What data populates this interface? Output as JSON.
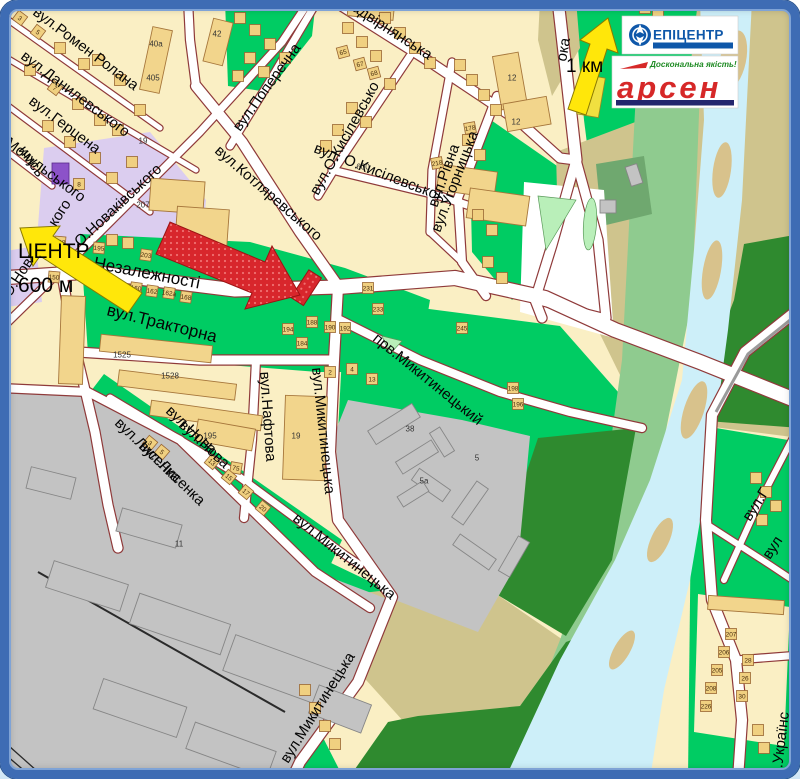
{
  "map": {
    "streets": [
      {
        "label": "вул.Ромен Ролана"
      },
      {
        "label": "вул.Данилевського"
      },
      {
        "label": "вул.Герцена"
      },
      {
        "label": "вул.Мочульського"
      },
      {
        "label": "имсь"
      },
      {
        "label": "О.Новаківського"
      },
      {
        "label": "О.Новаківського"
      },
      {
        "label": "вул.Поперечна"
      },
      {
        "label": "вул.О.Кисілевсько"
      },
      {
        "label": "вул. О.Кисілевської"
      },
      {
        "label": "вул.Рівна"
      },
      {
        "label": "Надвірнянська"
      },
      {
        "label": "вул.Угорницька"
      },
      {
        "label": "ока"
      },
      {
        "label": "вул.Котляревського"
      },
      {
        "label": "вул.Незалежності"
      },
      {
        "label": "вул.Тракторна"
      },
      {
        "label": "вул.Нафтова"
      },
      {
        "label": "прв.Микитинецький"
      },
      {
        "label": "вул.Микитинецька"
      },
      {
        "label": "вул.Микитинецька"
      },
      {
        "label": "вул.Микитинецька"
      },
      {
        "label": "вул.Нова"
      },
      {
        "label": "вул.Нова"
      },
      {
        "label": "вул.Лисенка"
      },
      {
        "label": "вул.Лисенка"
      },
      {
        "label": "вул.Г"
      },
      {
        "label": "вул"
      },
      {
        "label": "л.Українс"
      }
    ],
    "annotations": {
      "center": {
        "title": "ЦЕНТР",
        "distance": "600 м"
      },
      "north": {
        "distance": "1 км"
      }
    },
    "logos": {
      "epicentr": {
        "name": "ЕПІЦЕНТР"
      },
      "arsen": {
        "name": "арсен",
        "tagline": "Доскональна якість!"
      }
    },
    "colors": {
      "frame_blue": "#3E6CB4",
      "road_casing": "#8F3A3A",
      "green": "#00CC63",
      "light_green": "#B9EFB9",
      "sage": "#8FCB8F",
      "forest": "#2F8A2F",
      "khaki": "#CFC48D",
      "river": "#CDEFF9",
      "gray": "#C3C3C3",
      "building_tan": "#F2D58C",
      "purple": "#DBCDEF",
      "highlight_red": "#D8262C",
      "arrow_yellow": "#FFE70A",
      "epicentr_blue": "#0E57A9",
      "arsen_red": "#D62828"
    },
    "building_markers": [
      {
        "x": 156,
        "y": 44,
        "n": "40а",
        "b": 0
      },
      {
        "x": 153,
        "y": 78,
        "n": "405",
        "b": 0
      },
      {
        "x": 217,
        "y": 34,
        "n": "42",
        "b": 0
      },
      {
        "x": 143,
        "y": 205,
        "n": "207",
        "b": 0
      },
      {
        "x": 122,
        "y": 355,
        "n": "1525",
        "b": 0
      },
      {
        "x": 170,
        "y": 376,
        "n": "1528",
        "b": 0
      },
      {
        "x": 296,
        "y": 436,
        "n": "19",
        "b": 0
      },
      {
        "x": 210,
        "y": 436,
        "n": "195",
        "b": 0
      },
      {
        "x": 179,
        "y": 544,
        "n": "11",
        "b": 0
      },
      {
        "x": 410,
        "y": 429,
        "n": "38",
        "b": 0
      },
      {
        "x": 424,
        "y": 481,
        "n": "5а",
        "b": 0
      },
      {
        "x": 477,
        "y": 458,
        "n": "5",
        "b": 0
      },
      {
        "x": 512,
        "y": 78,
        "n": "12",
        "b": 0
      },
      {
        "x": 516,
        "y": 122,
        "n": "12",
        "b": 0
      },
      {
        "x": 143,
        "y": 141,
        "n": "19",
        "b": 0
      },
      {
        "x": 363,
        "y": 167,
        "n": "600",
        "b": 0
      },
      {
        "x": 20,
        "y": 18,
        "n": "3",
        "r": 37
      },
      {
        "x": 38,
        "y": 32,
        "n": "5",
        "r": 37
      },
      {
        "x": 55,
        "y": 88,
        "n": "7",
        "r": 37
      },
      {
        "x": 79,
        "y": 184,
        "n": "8"
      },
      {
        "x": 343,
        "y": 52,
        "n": "65",
        "r": -15
      },
      {
        "x": 360,
        "y": 64,
        "n": "67",
        "r": -15
      },
      {
        "x": 374,
        "y": 73,
        "n": "68",
        "r": -15
      },
      {
        "x": 437,
        "y": 163,
        "n": "218",
        "r": -10
      },
      {
        "x": 470,
        "y": 128,
        "n": "178",
        "r": -10
      },
      {
        "x": 54,
        "y": 277,
        "n": "150",
        "r": 5
      },
      {
        "x": 60,
        "y": 242,
        "n": "198",
        "r": 5
      },
      {
        "x": 99,
        "y": 248,
        "n": "195",
        "r": 5
      },
      {
        "x": 136,
        "y": 288,
        "n": "160",
        "r": 8
      },
      {
        "x": 152,
        "y": 291,
        "n": "162",
        "r": 8
      },
      {
        "x": 169,
        "y": 293,
        "n": "162а",
        "r": 8
      },
      {
        "x": 186,
        "y": 297,
        "n": "168",
        "r": 8
      },
      {
        "x": 146,
        "y": 255,
        "n": "203",
        "r": 8
      },
      {
        "x": 196,
        "y": 263,
        "n": "206",
        "r": 8
      },
      {
        "x": 368,
        "y": 288,
        "n": "231"
      },
      {
        "x": 378,
        "y": 309,
        "n": "233"
      },
      {
        "x": 462,
        "y": 328,
        "n": "245"
      },
      {
        "x": 288,
        "y": 329,
        "n": "194"
      },
      {
        "x": 312,
        "y": 322,
        "n": "188"
      },
      {
        "x": 330,
        "y": 327,
        "n": "190"
      },
      {
        "x": 345,
        "y": 328,
        "n": "192"
      },
      {
        "x": 302,
        "y": 343,
        "n": "184"
      },
      {
        "x": 513,
        "y": 388,
        "n": "198"
      },
      {
        "x": 518,
        "y": 404,
        "n": "196"
      },
      {
        "x": 236,
        "y": 468,
        "n": "75",
        "r": 10
      },
      {
        "x": 162,
        "y": 452,
        "n": "5",
        "r": 40
      },
      {
        "x": 150,
        "y": 443,
        "n": "3",
        "r": 40
      },
      {
        "x": 212,
        "y": 462,
        "n": "13",
        "r": 40
      },
      {
        "x": 229,
        "y": 477,
        "n": "15",
        "r": 40
      },
      {
        "x": 246,
        "y": 492,
        "n": "17",
        "r": 40
      },
      {
        "x": 263,
        "y": 508,
        "n": "20",
        "r": 40
      },
      {
        "x": 330,
        "y": 372,
        "n": "2"
      },
      {
        "x": 352,
        "y": 369,
        "n": "4"
      },
      {
        "x": 372,
        "y": 379,
        "n": "13"
      },
      {
        "x": 731,
        "y": 634,
        "n": "207"
      },
      {
        "x": 724,
        "y": 652,
        "n": "206"
      },
      {
        "x": 717,
        "y": 670,
        "n": "205"
      },
      {
        "x": 711,
        "y": 688,
        "n": "208"
      },
      {
        "x": 706,
        "y": 706,
        "n": "226"
      },
      {
        "x": 748,
        "y": 660,
        "n": "28"
      },
      {
        "x": 745,
        "y": 678,
        "n": "26"
      },
      {
        "x": 742,
        "y": 696,
        "n": "30"
      },
      {
        "x": 60,
        "y": 48,
        "n": ""
      },
      {
        "x": 84,
        "y": 64,
        "n": ""
      },
      {
        "x": 30,
        "y": 70,
        "n": ""
      },
      {
        "x": 78,
        "y": 104,
        "n": ""
      },
      {
        "x": 100,
        "y": 120,
        "n": ""
      },
      {
        "x": 48,
        "y": 126,
        "n": ""
      },
      {
        "x": 70,
        "y": 142,
        "n": ""
      },
      {
        "x": 95,
        "y": 158,
        "n": ""
      },
      {
        "x": 118,
        "y": 130,
        "n": ""
      },
      {
        "x": 140,
        "y": 110,
        "n": ""
      },
      {
        "x": 120,
        "y": 80,
        "n": ""
      },
      {
        "x": 98,
        "y": 60,
        "n": ""
      },
      {
        "x": 112,
        "y": 178,
        "n": ""
      },
      {
        "x": 132,
        "y": 162,
        "n": ""
      },
      {
        "x": 240,
        "y": 18,
        "n": ""
      },
      {
        "x": 255,
        "y": 30,
        "n": ""
      },
      {
        "x": 270,
        "y": 44,
        "n": ""
      },
      {
        "x": 250,
        "y": 58,
        "n": ""
      },
      {
        "x": 264,
        "y": 72,
        "n": ""
      },
      {
        "x": 285,
        "y": 58,
        "n": ""
      },
      {
        "x": 238,
        "y": 76,
        "n": ""
      },
      {
        "x": 348,
        "y": 28,
        "n": ""
      },
      {
        "x": 362,
        "y": 42,
        "n": ""
      },
      {
        "x": 376,
        "y": 56,
        "n": ""
      },
      {
        "x": 390,
        "y": 84,
        "n": ""
      },
      {
        "x": 352,
        "y": 108,
        "n": ""
      },
      {
        "x": 366,
        "y": 122,
        "n": ""
      },
      {
        "x": 338,
        "y": 130,
        "n": ""
      },
      {
        "x": 326,
        "y": 146,
        "n": ""
      },
      {
        "x": 385,
        "y": 18,
        "n": ""
      },
      {
        "x": 400,
        "y": 33,
        "n": ""
      },
      {
        "x": 415,
        "y": 48,
        "n": ""
      },
      {
        "x": 430,
        "y": 63,
        "n": ""
      },
      {
        "x": 460,
        "y": 65,
        "n": ""
      },
      {
        "x": 472,
        "y": 80,
        "n": ""
      },
      {
        "x": 484,
        "y": 95,
        "n": ""
      },
      {
        "x": 496,
        "y": 110,
        "n": ""
      },
      {
        "x": 468,
        "y": 140,
        "n": ""
      },
      {
        "x": 480,
        "y": 155,
        "n": ""
      },
      {
        "x": 478,
        "y": 215,
        "n": ""
      },
      {
        "x": 492,
        "y": 230,
        "n": ""
      },
      {
        "x": 488,
        "y": 262,
        "n": ""
      },
      {
        "x": 502,
        "y": 278,
        "n": ""
      },
      {
        "x": 645,
        "y": 8,
        "n": ""
      },
      {
        "x": 658,
        "y": 15,
        "n": ""
      },
      {
        "x": 671,
        "y": 22,
        "n": ""
      },
      {
        "x": 684,
        "y": 29,
        "n": ""
      },
      {
        "x": 652,
        "y": 32,
        "n": ""
      },
      {
        "x": 756,
        "y": 478,
        "n": ""
      },
      {
        "x": 766,
        "y": 492,
        "n": ""
      },
      {
        "x": 776,
        "y": 506,
        "n": ""
      },
      {
        "x": 762,
        "y": 520,
        "n": ""
      },
      {
        "x": 305,
        "y": 690,
        "n": ""
      },
      {
        "x": 315,
        "y": 708,
        "n": ""
      },
      {
        "x": 325,
        "y": 726,
        "n": ""
      },
      {
        "x": 335,
        "y": 744,
        "n": ""
      },
      {
        "x": 112,
        "y": 240,
        "n": ""
      },
      {
        "x": 128,
        "y": 243,
        "n": ""
      },
      {
        "x": 758,
        "y": 730,
        "n": ""
      },
      {
        "x": 764,
        "y": 748,
        "n": ""
      }
    ]
  }
}
